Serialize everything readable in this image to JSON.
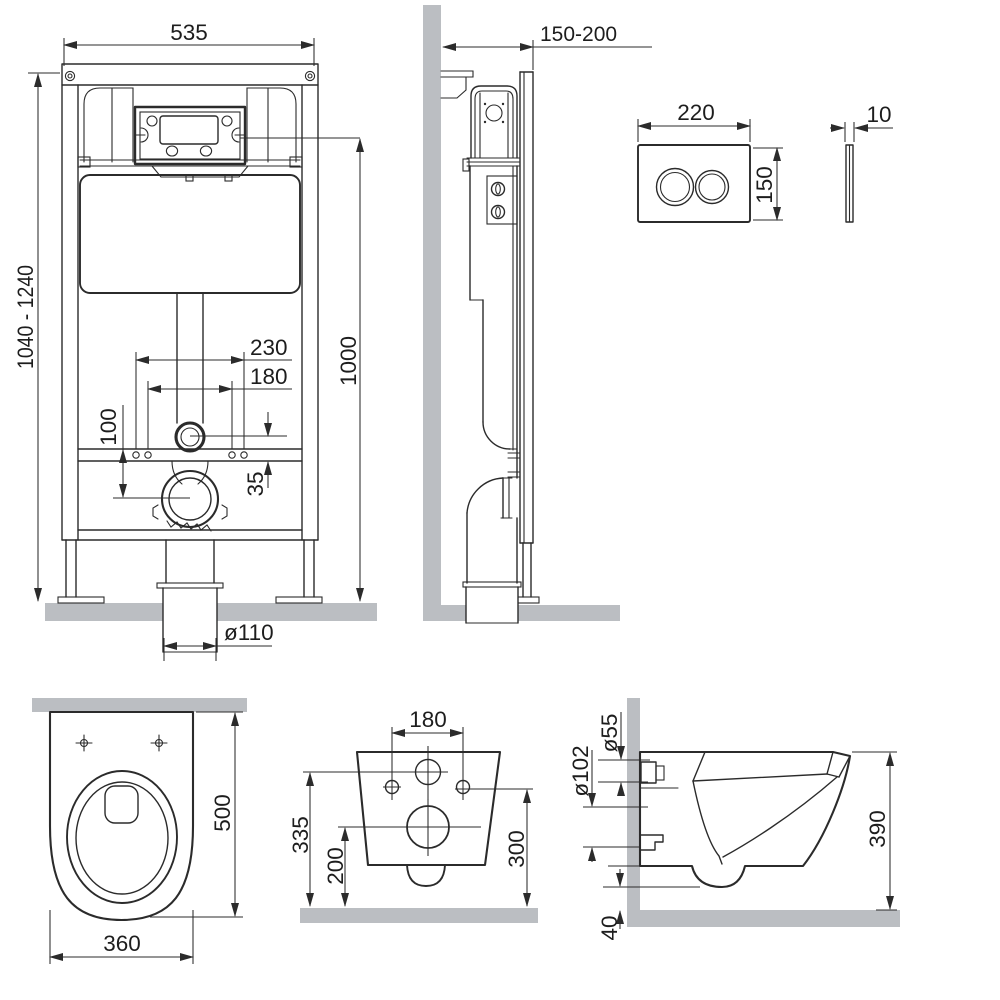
{
  "colors": {
    "line": "#2b2b2b",
    "dim_text": "#1d1d1d",
    "surface": "#bbbec2",
    "background": "#ffffff"
  },
  "views": {
    "frame_front": {
      "dims": {
        "width": "535",
        "height_range": "1040 - 1240",
        "install_height": "1000",
        "fixing_spacing_outer": "230",
        "fixing_spacing_inner": "180",
        "outlet_drop": "100",
        "inlet_offset": "35",
        "drain_diameter": "ø110"
      }
    },
    "frame_side": {
      "dims": {
        "depth_range": "150-200"
      }
    },
    "flush_plate_front": {
      "dims": {
        "width": "220",
        "height": "150"
      }
    },
    "flush_plate_side": {
      "dims": {
        "thickness": "10"
      }
    },
    "bowl_top": {
      "dims": {
        "depth": "500",
        "width": "360"
      }
    },
    "bowl_rear": {
      "dims": {
        "hole_spacing": "180",
        "inlet_height": "335",
        "outlet_height": "200",
        "hole_height": "300"
      }
    },
    "bowl_side": {
      "dims": {
        "inlet_diameter": "ø55",
        "outlet_diameter": "ø102",
        "height": "390",
        "floor_clearance": "40"
      }
    }
  }
}
